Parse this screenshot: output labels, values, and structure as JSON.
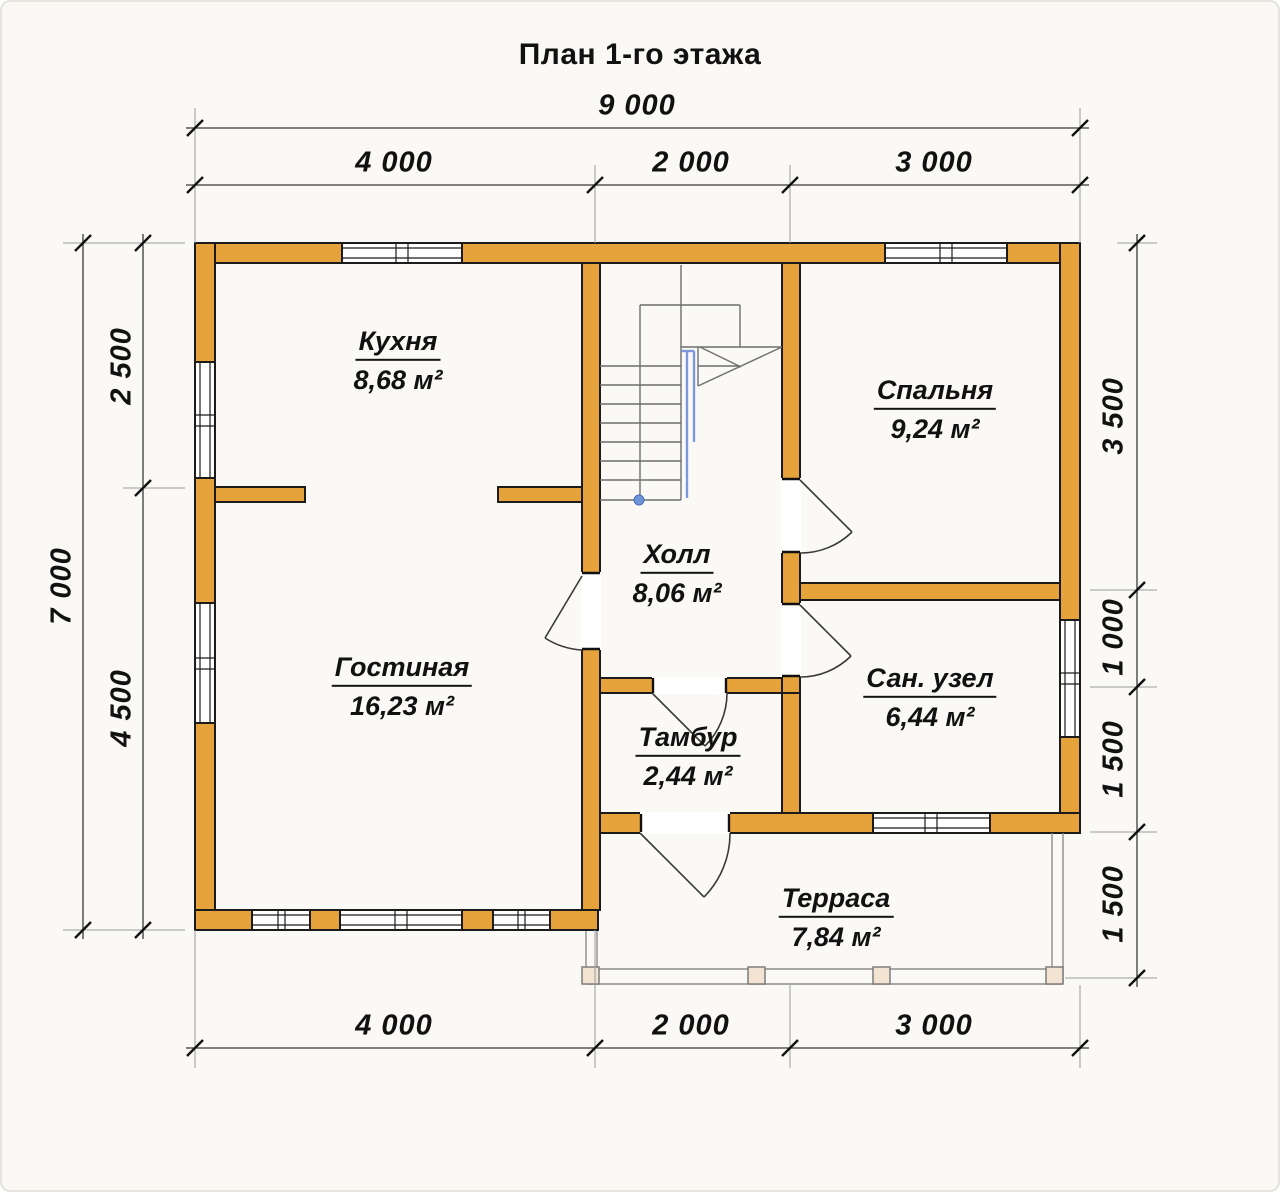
{
  "title": "План 1-го этажа",
  "rooms": [
    {
      "name": "Кухня",
      "area": "8,68 м²"
    },
    {
      "name": "Спальня",
      "area": "9,24 м²"
    },
    {
      "name": "Холл",
      "area": "8,06 м²"
    },
    {
      "name": "Гостиная",
      "area": "16,23 м²"
    },
    {
      "name": "Сан. узел",
      "area": "6,44 м²"
    },
    {
      "name": "Тамбур",
      "area": "2,44 м²"
    },
    {
      "name": "Терраса",
      "area": "7,84 м²"
    }
  ],
  "dimensions": {
    "top_total": "9 000",
    "top_segments": [
      "4 000",
      "2 000",
      "3 000"
    ],
    "bottom_segments": [
      "4 000",
      "2 000",
      "3 000"
    ],
    "left_total": "7 000",
    "left_segments": [
      "2 500",
      "4 500"
    ],
    "right_segments": [
      "3 500",
      "1 000",
      "1 500",
      "1 500"
    ]
  },
  "colors": {
    "wall": "#E7A33B",
    "post": "#F2E3D3",
    "railing": "#7E99DB",
    "dot": "#6F93D8"
  }
}
